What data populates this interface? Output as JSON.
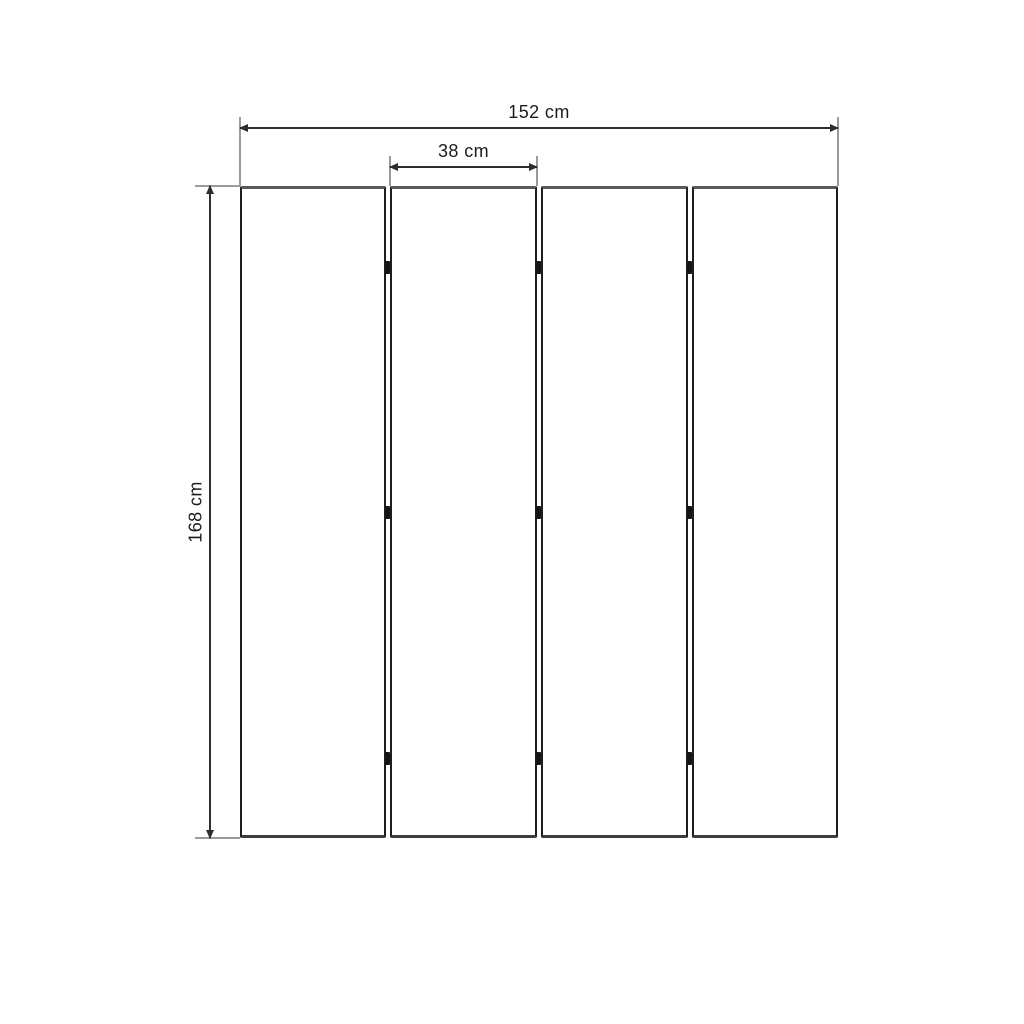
{
  "diagram": {
    "type": "product-dimension-drawing",
    "panel_count": 4,
    "hinge_marks_per_junction": 3,
    "labels": {
      "total_width": "152 cm",
      "single_panel_width": "38 cm",
      "height": "168 cm"
    },
    "colors": {
      "background": "#ffffff",
      "dimension_line": "#2d2d2d",
      "extension_line": "#9b9b9b",
      "panel_edge_top": "#595959",
      "panel_edge_bottom": "#3d3d3d",
      "panel_edge_side": "#1e1e1e",
      "hinge": "#151515",
      "label_text": "#1c1c1c"
    }
  }
}
